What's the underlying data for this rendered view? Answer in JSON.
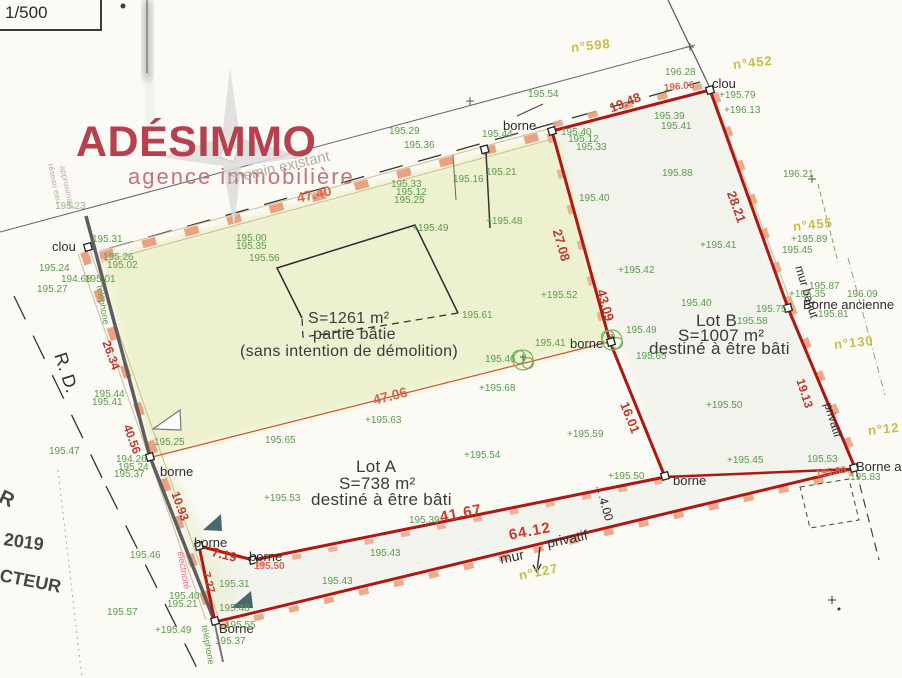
{
  "scale_label": "1/500",
  "logo": {
    "name": "ADÉSIMMO",
    "tagline": "agence immobilière"
  },
  "building": {
    "area": "S=1261 m²",
    "type": "partie bâtie",
    "note": "(sans intention de démolition)"
  },
  "lots": [
    {
      "name": "Lot A",
      "area": "S=738 m²",
      "note": "destiné à être bâti"
    },
    {
      "name": "Lot B",
      "area": "S=1007 m²",
      "note": "destiné à être bâti"
    }
  ],
  "colors": {
    "boundary_red": "#b01712",
    "wall_salmon": "#eba181",
    "elevation_green": "#5a9c4c",
    "dimension_red": "#c0392b",
    "parcel_yellow": "#c9bd4a",
    "logo_red": "#b7404f",
    "tint_zone": "#ecf0c8"
  },
  "annotations": [
    {
      "t": "clou",
      "x": 52,
      "y": 240,
      "c": "k"
    },
    {
      "t": "clou",
      "x": 712,
      "y": 77,
      "c": "k"
    },
    {
      "t": "borne",
      "x": 503,
      "y": 119,
      "c": "k"
    },
    {
      "t": "borne",
      "x": 160,
      "y": 465,
      "c": "k"
    },
    {
      "t": "borne",
      "x": 570,
      "y": 337,
      "c": "k"
    },
    {
      "t": "borne",
      "x": 673,
      "y": 474,
      "c": "k"
    },
    {
      "t": "borne",
      "x": 194,
      "y": 536,
      "c": "k"
    },
    {
      "t": "borne",
      "x": 249,
      "y": 550,
      "c": "k"
    },
    {
      "t": "Borne",
      "x": 219,
      "y": 622,
      "c": "k"
    },
    {
      "t": "Borne ancienne",
      "x": 803,
      "y": 298,
      "c": "k"
    },
    {
      "t": "Borne ancienne",
      "x": 856,
      "y": 460,
      "c": "k"
    },
    {
      "t": "R. D.",
      "x": 60,
      "y": 344,
      "c": "k",
      "f": 18,
      "r": 72
    },
    {
      "t": "mur bahut",
      "x": 799,
      "y": 260,
      "c": "k",
      "f": 12,
      "r": 73
    },
    {
      "t": "privatif",
      "x": 828,
      "y": 397,
      "c": "k",
      "f": 12,
      "r": 73
    },
    {
      "t": "mur",
      "x": 500,
      "y": 552,
      "c": "k",
      "f": 14,
      "r": -12
    },
    {
      "t": "privatif",
      "x": 547,
      "y": 536,
      "c": "k",
      "f": 14,
      "r": -12
    },
    {
      "t": "4.00",
      "x": 603,
      "y": 492,
      "c": "k",
      "f": 12,
      "r": 74
    },
    {
      "t": "chemin existant",
      "x": 228,
      "y": 172,
      "c": "gray",
      "f": 15,
      "r": -13
    },
    {
      "t": "réseau eau",
      "x": 50,
      "y": 160,
      "c": "gray",
      "f": 8,
      "r": 78
    },
    {
      "t": "approximatif",
      "x": 62,
      "y": 162,
      "c": "gray",
      "f": 8,
      "r": 78
    },
    {
      "t": "téléphone",
      "x": 99,
      "y": 281,
      "c": "g",
      "f": 9,
      "r": 80
    },
    {
      "t": "téléphone",
      "x": 204,
      "y": 621,
      "c": "g",
      "f": 9,
      "r": 80
    },
    {
      "t": "électricité",
      "x": 180,
      "y": 547,
      "c": "pink",
      "f": 9,
      "r": 80
    },
    {
      "t": "2019",
      "x": 4,
      "y": 530,
      "c": "stamp",
      "f": 18,
      "r": 8
    },
    {
      "t": "R",
      "x": 0,
      "y": 486,
      "c": "stamp",
      "f": 20,
      "r": 25
    },
    {
      "t": "CTEUR",
      "x": 0,
      "y": 566,
      "c": "stamp",
      "f": 18,
      "r": 11
    },
    {
      "t": "47.40",
      "x": 297,
      "y": 191,
      "c": "r2",
      "f": 14,
      "r": -13
    },
    {
      "t": "19.48",
      "x": 610,
      "y": 102,
      "c": "r",
      "f": 13,
      "r": -22
    },
    {
      "t": "28.21",
      "x": 731,
      "y": 185,
      "c": "r",
      "f": 13,
      "r": 70
    },
    {
      "t": "19.13",
      "x": 800,
      "y": 373,
      "c": "r",
      "f": 12,
      "r": 72
    },
    {
      "t": "27.08",
      "x": 557,
      "y": 223,
      "c": "r",
      "f": 13,
      "r": 74
    },
    {
      "t": "43.09",
      "x": 601,
      "y": 283,
      "c": "r",
      "f": 13,
      "r": 74
    },
    {
      "t": "16.01",
      "x": 624,
      "y": 396,
      "c": "r",
      "f": 13,
      "r": 68
    },
    {
      "t": "41.67",
      "x": 440,
      "y": 510,
      "c": "rb",
      "f": 15,
      "r": -11
    },
    {
      "t": "64.12",
      "x": 509,
      "y": 528,
      "c": "rb",
      "f": 15,
      "r": -11
    },
    {
      "t": "26.34",
      "x": 106,
      "y": 335,
      "c": "r",
      "f": 12,
      "r": 70
    },
    {
      "t": "40.56",
      "x": 127,
      "y": 419,
      "c": "r",
      "f": 12,
      "r": 70
    },
    {
      "t": "10.93",
      "x": 175,
      "y": 486,
      "c": "r",
      "f": 12,
      "r": 70
    },
    {
      "t": "7.19",
      "x": 212,
      "y": 545,
      "c": "r",
      "f": 13,
      "r": 14
    },
    {
      "t": "7.27",
      "x": 205,
      "y": 567,
      "c": "r",
      "f": 11,
      "r": 75
    },
    {
      "t": "195.50",
      "x": 254,
      "y": 562,
      "c": "r2",
      "f": 10
    },
    {
      "t": "195.80",
      "x": 816,
      "y": 470,
      "c": "r2",
      "f": 10,
      "r": -8
    },
    {
      "t": "196.06",
      "x": 664,
      "y": 84,
      "c": "r2",
      "f": 10,
      "r": -6
    },
    {
      "t": "47.06",
      "x": 373,
      "y": 393,
      "c": "r2",
      "f": 14,
      "r": -14
    },
    {
      "t": "n°598",
      "x": 571,
      "y": 41,
      "c": "y",
      "r": -6
    },
    {
      "t": "n°452",
      "x": 733,
      "y": 58,
      "c": "y",
      "r": -6
    },
    {
      "t": "n°455",
      "x": 793,
      "y": 220,
      "c": "y",
      "r": -6
    },
    {
      "t": "n°130",
      "x": 834,
      "y": 338,
      "c": "y",
      "r": -6
    },
    {
      "t": "n°12",
      "x": 868,
      "y": 424,
      "c": "y",
      "r": -6
    },
    {
      "t": "n°127",
      "x": 519,
      "y": 569,
      "c": "y",
      "r": -11
    },
    {
      "t": "195.31",
      "x": 92,
      "y": 235,
      "c": "g"
    },
    {
      "t": "195.26",
      "x": 103,
      "y": 253,
      "c": "g"
    },
    {
      "t": "195.02",
      "x": 107,
      "y": 261,
      "c": "g"
    },
    {
      "t": "195.24",
      "x": 39,
      "y": 264,
      "c": "g"
    },
    {
      "t": "194.68",
      "x": 61,
      "y": 275,
      "c": "g"
    },
    {
      "t": "195.01",
      "x": 85,
      "y": 275,
      "c": "g"
    },
    {
      "t": "195.27",
      "x": 37,
      "y": 285,
      "c": "g"
    },
    {
      "t": "195.23",
      "x": 55,
      "y": 202,
      "c": "gf"
    },
    {
      "t": "195.29",
      "x": 389,
      "y": 127,
      "c": "g"
    },
    {
      "t": "195.36",
      "x": 404,
      "y": 141,
      "c": "g"
    },
    {
      "t": "195.33",
      "x": 391,
      "y": 180,
      "c": "g"
    },
    {
      "t": "195.12",
      "x": 396,
      "y": 188,
      "c": "g"
    },
    {
      "t": "195.25",
      "x": 394,
      "y": 196,
      "c": "g"
    },
    {
      "t": "195.16",
      "x": 453,
      "y": 175,
      "c": "g"
    },
    {
      "t": "195.21",
      "x": 486,
      "y": 168,
      "c": "g"
    },
    {
      "t": "195.54",
      "x": 528,
      "y": 90,
      "c": "g"
    },
    {
      "t": "196.28",
      "x": 665,
      "y": 68,
      "c": "g"
    },
    {
      "t": "+195.79",
      "x": 719,
      "y": 91,
      "c": "g"
    },
    {
      "t": "+196.13",
      "x": 724,
      "y": 106,
      "c": "g"
    },
    {
      "t": "195.39",
      "x": 654,
      "y": 112,
      "c": "g"
    },
    {
      "t": "195.41",
      "x": 661,
      "y": 122,
      "c": "g"
    },
    {
      "t": "195.44",
      "x": 482,
      "y": 130,
      "c": "g"
    },
    {
      "t": "195.40",
      "x": 561,
      "y": 128,
      "c": "g"
    },
    {
      "t": "195.12",
      "x": 568,
      "y": 135,
      "c": "g"
    },
    {
      "t": "195.33",
      "x": 576,
      "y": 143,
      "c": "g"
    },
    {
      "t": "+195.41",
      "x": 700,
      "y": 241,
      "c": "g"
    },
    {
      "t": "+195.89",
      "x": 791,
      "y": 235,
      "c": "g"
    },
    {
      "t": "195.45",
      "x": 782,
      "y": 246,
      "c": "g"
    },
    {
      "t": "196.21",
      "x": 783,
      "y": 170,
      "c": "g"
    },
    {
      "t": "195.40",
      "x": 579,
      "y": 194,
      "c": "g"
    },
    {
      "t": "195.88",
      "x": 662,
      "y": 169,
      "c": "g"
    },
    {
      "t": "+195.42",
      "x": 618,
      "y": 266,
      "c": "g"
    },
    {
      "t": "+195.52",
      "x": 541,
      "y": 291,
      "c": "g"
    },
    {
      "t": "195.40",
      "x": 681,
      "y": 299,
      "c": "g"
    },
    {
      "t": "195.58",
      "x": 737,
      "y": 317,
      "c": "g"
    },
    {
      "t": "195.75",
      "x": 756,
      "y": 305,
      "c": "g"
    },
    {
      "t": "195.87",
      "x": 809,
      "y": 282,
      "c": "g"
    },
    {
      "t": "+195.35",
      "x": 789,
      "y": 290,
      "c": "g"
    },
    {
      "t": "196.09",
      "x": 847,
      "y": 290,
      "c": "g"
    },
    {
      "t": "195.81",
      "x": 818,
      "y": 310,
      "c": "g"
    },
    {
      "t": "195.49",
      "x": 626,
      "y": 326,
      "c": "g"
    },
    {
      "t": "195.41",
      "x": 535,
      "y": 339,
      "c": "g"
    },
    {
      "t": "195.65",
      "x": 636,
      "y": 352,
      "c": "g"
    },
    {
      "t": "+195.50",
      "x": 706,
      "y": 401,
      "c": "g"
    },
    {
      "t": "+195.59",
      "x": 567,
      "y": 430,
      "c": "g"
    },
    {
      "t": "+195.50",
      "x": 608,
      "y": 472,
      "c": "g"
    },
    {
      "t": "195.53",
      "x": 807,
      "y": 455,
      "c": "g"
    },
    {
      "t": "195.83",
      "x": 850,
      "y": 473,
      "c": "g"
    },
    {
      "t": "+195.45",
      "x": 727,
      "y": 456,
      "c": "g"
    },
    {
      "t": "+195.53",
      "x": 264,
      "y": 494,
      "c": "g"
    },
    {
      "t": "+195.54",
      "x": 464,
      "y": 451,
      "c": "g"
    },
    {
      "t": "195.39",
      "x": 409,
      "y": 516,
      "c": "g"
    },
    {
      "t": "195.43",
      "x": 370,
      "y": 549,
      "c": "g"
    },
    {
      "t": "195.43",
      "x": 322,
      "y": 577,
      "c": "g"
    },
    {
      "t": "195.65",
      "x": 265,
      "y": 436,
      "c": "g"
    },
    {
      "t": "195.25",
      "x": 154,
      "y": 438,
      "c": "g"
    },
    {
      "t": "195.47",
      "x": 49,
      "y": 447,
      "c": "g"
    },
    {
      "t": "195.44",
      "x": 94,
      "y": 390,
      "c": "g"
    },
    {
      "t": "195.41",
      "x": 92,
      "y": 398,
      "c": "g"
    },
    {
      "t": "195.46",
      "x": 130,
      "y": 551,
      "c": "g"
    },
    {
      "t": "194.26",
      "x": 116,
      "y": 455,
      "c": "g"
    },
    {
      "t": "195.24",
      "x": 118,
      "y": 463,
      "c": "g"
    },
    {
      "t": "195.37",
      "x": 114,
      "y": 470,
      "c": "g"
    },
    {
      "t": "+195.49",
      "x": 155,
      "y": 626,
      "c": "g"
    },
    {
      "t": "195.40",
      "x": 169,
      "y": 592,
      "c": "g"
    },
    {
      "t": "195.21",
      "x": 167,
      "y": 600,
      "c": "g"
    },
    {
      "t": "195.48",
      "x": 219,
      "y": 604,
      "c": "g"
    },
    {
      "t": "195.55",
      "x": 225,
      "y": 621,
      "c": "g"
    },
    {
      "t": "195.37",
      "x": 215,
      "y": 637,
      "c": "g"
    },
    {
      "t": "195.57",
      "x": 107,
      "y": 608,
      "c": "g"
    },
    {
      "t": "195.31",
      "x": 219,
      "y": 580,
      "c": "g"
    },
    {
      "t": "195.61",
      "x": 462,
      "y": 311,
      "c": "g"
    },
    {
      "t": "+195.49",
      "x": 412,
      "y": 224,
      "c": "g"
    },
    {
      "t": "+195.48",
      "x": 486,
      "y": 217,
      "c": "g"
    },
    {
      "t": "195.00",
      "x": 236,
      "y": 234,
      "c": "g"
    },
    {
      "t": "195.35",
      "x": 236,
      "y": 242,
      "c": "g"
    },
    {
      "t": "195.56",
      "x": 249,
      "y": 254,
      "c": "g"
    },
    {
      "t": "+195.68",
      "x": 479,
      "y": 384,
      "c": "g"
    },
    {
      "t": "+195.63",
      "x": 365,
      "y": 416,
      "c": "g"
    },
    {
      "t": "195.46",
      "x": 485,
      "y": 355,
      "c": "g"
    }
  ]
}
